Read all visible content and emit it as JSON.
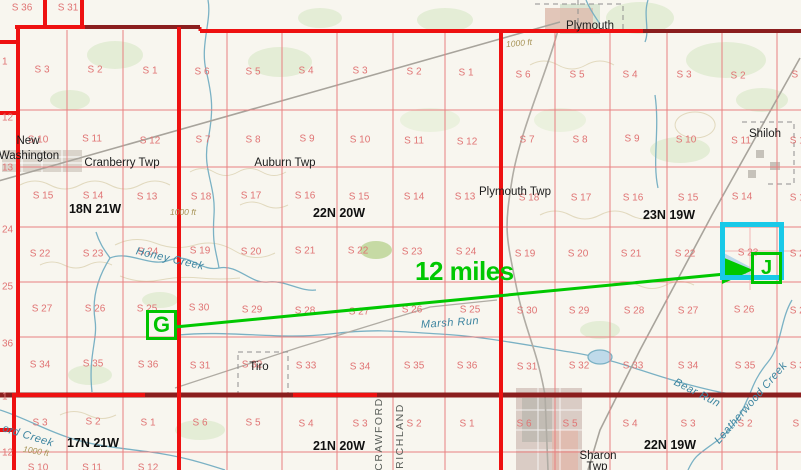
{
  "map_title": "township and range survey map",
  "measurement": {
    "start_label": "G",
    "end_label": "J",
    "distance_label": "12 miles"
  },
  "colors": {
    "annotation_green": "#00c400",
    "highlight_cyan": "#19c9e8",
    "section_line_red": "#e98080",
    "boundary_red": "#ee1111",
    "boundary_dark_red": "#8b1e1e",
    "section_text": "#e07474",
    "water": "#74aec2",
    "water_text": "#3d85a0",
    "contour_text": "#a79356",
    "county_text": "#5a5f5a"
  },
  "labels": {
    "townships": [
      [
        "18N 21W",
        95,
        209
      ],
      [
        "22N 20W",
        339,
        213
      ],
      [
        "23N 19W",
        669,
        215
      ],
      [
        "17N 21W",
        93,
        443
      ],
      [
        "21N 20W",
        339,
        446
      ],
      [
        "22N 19W",
        670,
        445
      ],
      [
        "19N 21W",
        64,
        -4
      ]
    ],
    "places": [
      [
        "Plymouth",
        590,
        26
      ],
      [
        "New",
        28,
        141
      ],
      [
        "Washington",
        29,
        156
      ],
      [
        "Cranberry Twp",
        122,
        163
      ],
      [
        "Auburn Twp",
        285,
        163
      ],
      [
        "Plymouth Twp",
        515,
        192
      ],
      [
        "Shiloh",
        765,
        134
      ],
      [
        "Tiro",
        259,
        367
      ],
      [
        "Sharon",
        598,
        456
      ],
      [
        "Twp",
        597,
        467
      ]
    ],
    "water": [
      [
        "Honey Creek",
        170,
        259,
        13
      ],
      [
        "Marsh Run",
        450,
        323,
        -4
      ],
      [
        "Bear Run",
        697,
        393,
        27
      ],
      [
        "Leatherwood Creek",
        751,
        403,
        -49
      ],
      [
        "ord Creek",
        28,
        436,
        17
      ]
    ],
    "contours": [
      [
        "1000 ft",
        519,
        43,
        -5
      ],
      [
        "1000 ft",
        183,
        212,
        0
      ],
      [
        "1000 ft",
        36,
        451,
        10
      ]
    ],
    "counties": [
      [
        "CRAWFORD",
        379,
        434,
        -90
      ],
      [
        "RICHLAND",
        400,
        436,
        -90
      ]
    ],
    "edges": [
      [
        "1",
        2,
        62
      ],
      [
        "12",
        2,
        118
      ],
      [
        "13",
        2,
        168
      ],
      [
        "24",
        2,
        230
      ],
      [
        "25",
        2,
        287
      ],
      [
        "36",
        2,
        344
      ],
      [
        "1",
        2,
        397
      ],
      [
        "12",
        2,
        453
      ]
    ],
    "sections": [
      [
        "S 36",
        22,
        8
      ],
      [
        "S 31",
        68,
        8
      ],
      [
        "S 3",
        42,
        70
      ],
      [
        "S 2",
        95,
        70
      ],
      [
        "S 1",
        150,
        71
      ],
      [
        "S 10",
        38,
        140
      ],
      [
        "S 11",
        92,
        139
      ],
      [
        "S 12",
        150,
        141
      ],
      [
        "S 15",
        43,
        196
      ],
      [
        "S 14",
        93,
        196
      ],
      [
        "S 13",
        147,
        197
      ],
      [
        "S 22",
        40,
        254
      ],
      [
        "S 23",
        93,
        254
      ],
      [
        "S 24",
        148,
        252
      ],
      [
        "S 27",
        42,
        309
      ],
      [
        "S 26",
        95,
        309
      ],
      [
        "S 25",
        147,
        309
      ],
      [
        "S 34",
        40,
        365
      ],
      [
        "S 35",
        93,
        364
      ],
      [
        "S 36",
        148,
        365
      ],
      [
        "S 6",
        202,
        72
      ],
      [
        "S 5",
        253,
        72
      ],
      [
        "S 4",
        306,
        71
      ],
      [
        "S 3",
        360,
        71
      ],
      [
        "S 2",
        414,
        72
      ],
      [
        "S 1",
        466,
        73
      ],
      [
        "S 7",
        203,
        140
      ],
      [
        "S 8",
        253,
        140
      ],
      [
        "S 9",
        307,
        139
      ],
      [
        "S 10",
        360,
        140
      ],
      [
        "S 11",
        414,
        141
      ],
      [
        "S 12",
        467,
        142
      ],
      [
        "S 18",
        201,
        197
      ],
      [
        "S 17",
        251,
        196
      ],
      [
        "S 16",
        305,
        196
      ],
      [
        "S 15",
        359,
        197
      ],
      [
        "S 14",
        414,
        197
      ],
      [
        "S 13",
        465,
        197
      ],
      [
        "S 19",
        200,
        251
      ],
      [
        "S 20",
        251,
        252
      ],
      [
        "S 21",
        305,
        251
      ],
      [
        "S 22",
        358,
        251
      ],
      [
        "S 23",
        412,
        252
      ],
      [
        "S 24",
        466,
        252
      ],
      [
        "S 30",
        199,
        308
      ],
      [
        "S 29",
        252,
        310
      ],
      [
        "S 28",
        305,
        311
      ],
      [
        "S 27",
        359,
        312
      ],
      [
        "S 26",
        412,
        310
      ],
      [
        "S 25",
        470,
        310
      ],
      [
        "S 31",
        200,
        366
      ],
      [
        "S 32",
        252,
        365
      ],
      [
        "S 33",
        306,
        366
      ],
      [
        "S 34",
        360,
        367
      ],
      [
        "S 35",
        414,
        366
      ],
      [
        "S 36",
        467,
        366
      ],
      [
        "S 6",
        523,
        75
      ],
      [
        "S 5",
        577,
        75
      ],
      [
        "S 4",
        630,
        75
      ],
      [
        "S 3",
        684,
        75
      ],
      [
        "S 2",
        738,
        76
      ],
      [
        "S 7",
        527,
        140
      ],
      [
        "S 8",
        580,
        140
      ],
      [
        "S 9",
        632,
        139
      ],
      [
        "S 10",
        686,
        140
      ],
      [
        "S 11",
        741,
        141
      ],
      [
        "S 18",
        529,
        198
      ],
      [
        "S 17",
        581,
        198
      ],
      [
        "S 16",
        633,
        198
      ],
      [
        "S 15",
        688,
        198
      ],
      [
        "S 14",
        742,
        197
      ],
      [
        "S 19",
        525,
        254
      ],
      [
        "S 20",
        578,
        254
      ],
      [
        "S 21",
        631,
        254
      ],
      [
        "S 22",
        685,
        254
      ],
      [
        "S 23",
        748,
        253
      ],
      [
        "S 30",
        527,
        311
      ],
      [
        "S 29",
        579,
        311
      ],
      [
        "S 28",
        634,
        311
      ],
      [
        "S 27",
        688,
        311
      ],
      [
        "S 26",
        744,
        310
      ],
      [
        "S 31",
        527,
        367
      ],
      [
        "S 32",
        579,
        366
      ],
      [
        "S 33",
        633,
        366
      ],
      [
        "S 34",
        688,
        366
      ],
      [
        "S 35",
        745,
        366
      ],
      [
        "S 1",
        799,
        75
      ],
      [
        "S 12",
        800,
        141
      ],
      [
        "S 13",
        800,
        198
      ],
      [
        "S 24",
        800,
        254
      ],
      [
        "S 25",
        800,
        311
      ],
      [
        "S 36",
        800,
        366
      ],
      [
        "S 3",
        40,
        423
      ],
      [
        "S 2",
        93,
        422
      ],
      [
        "S 1",
        148,
        423
      ],
      [
        "S 10",
        38,
        468
      ],
      [
        "S 11",
        92,
        468
      ],
      [
        "S 12",
        148,
        468
      ],
      [
        "S 6",
        200,
        423
      ],
      [
        "S 5",
        253,
        423
      ],
      [
        "S 4",
        306,
        424
      ],
      [
        "S 3",
        360,
        424
      ],
      [
        "S 2",
        414,
        424
      ],
      [
        "S 1",
        467,
        424
      ],
      [
        "S 6",
        524,
        424
      ],
      [
        "S 5",
        570,
        424
      ],
      [
        "S 4",
        630,
        424
      ],
      [
        "S 3",
        688,
        424
      ],
      [
        "S 2",
        745,
        424
      ],
      [
        "S 1",
        800,
        424
      ]
    ]
  }
}
